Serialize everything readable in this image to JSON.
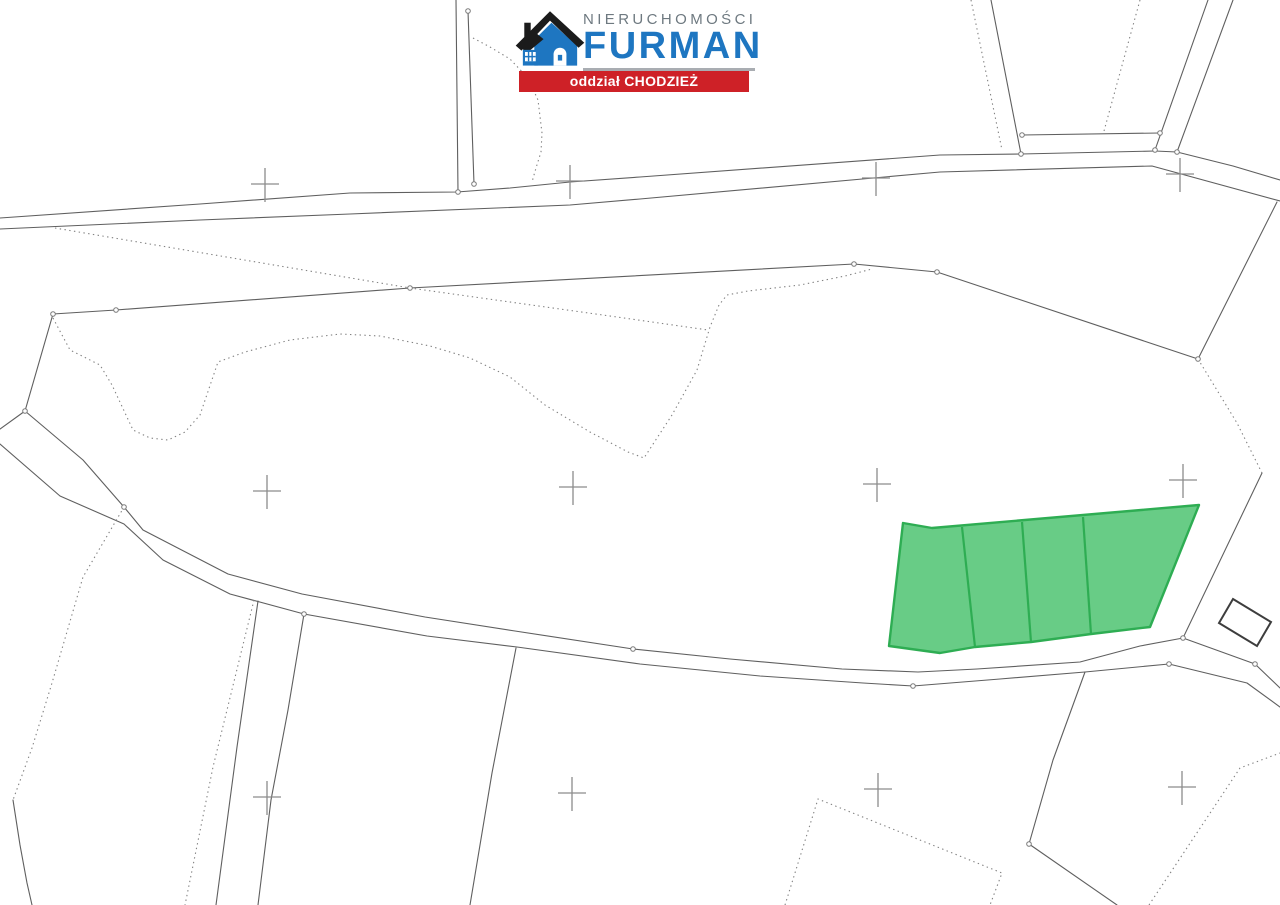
{
  "page": {
    "width": 1280,
    "height": 905,
    "background": "#ffffff"
  },
  "logo": {
    "brand_top": "NIERUCHOMOŚCI",
    "brand_main": "FURMAN",
    "banner_text": "oddział CHODZIEŻ",
    "colors": {
      "blue": "#1e76c1",
      "roof_dark": "#1b1b1b",
      "gray_text": "#6e7980",
      "underline": "#a9adb2",
      "banner_bg": "#ce2127",
      "banner_text": "#ffffff"
    }
  },
  "map": {
    "line_color": "#5f5f5f",
    "dotted_color": "#828282",
    "cross_color": "#8c8c8c",
    "vertex_color": "#7a7a7a",
    "green_fill": "#5bc87c",
    "green_stroke": "#2ead53",
    "line_width": 1.1,
    "dash_pattern": "1.4 3.4",
    "cross_arm_h": 14,
    "cross_arm_v": 16,
    "solid_lines": [
      {
        "name": "road-north-top-line",
        "points": [
          [
            0,
            218
          ],
          [
            200,
            204
          ],
          [
            350,
            193
          ],
          [
            457,
            192
          ],
          [
            510,
            188
          ],
          [
            570,
            182
          ],
          [
            640,
            177
          ],
          [
            940,
            155
          ],
          [
            1021,
            154
          ],
          [
            1155,
            151
          ],
          [
            1177,
            152
          ],
          [
            1233,
            166
          ],
          [
            1280,
            180
          ]
        ]
      },
      {
        "name": "road-north-bottom-line",
        "points": [
          [
            0,
            229
          ],
          [
            200,
            220
          ],
          [
            350,
            214
          ],
          [
            570,
            205
          ],
          [
            640,
            199
          ],
          [
            940,
            172
          ],
          [
            1152,
            166
          ],
          [
            1280,
            201
          ]
        ]
      },
      {
        "name": "north-vertical-boundary-1",
        "points": [
          [
            456,
            0
          ],
          [
            458,
            192
          ]
        ]
      },
      {
        "name": "north-vertical-boundary-2",
        "points": [
          [
            468,
            11
          ],
          [
            474,
            184
          ]
        ]
      },
      {
        "name": "upward-road-left-edge",
        "points": [
          [
            991,
            0
          ],
          [
            1021,
            154
          ]
        ]
      },
      {
        "name": "upward-road-right-edge-inner",
        "points": [
          [
            1208,
            0
          ],
          [
            1155,
            150
          ]
        ]
      },
      {
        "name": "upward-road-right-edge-outer",
        "points": [
          [
            1233,
            0
          ],
          [
            1177,
            152
          ]
        ]
      },
      {
        "name": "upward-road-connector",
        "points": [
          [
            1022,
            135
          ],
          [
            1160,
            133
          ]
        ]
      },
      {
        "name": "big-parcel-north-boundary",
        "points": [
          [
            53,
            314
          ],
          [
            116,
            310
          ],
          [
            410,
            288
          ],
          [
            854,
            264
          ],
          [
            937,
            272
          ],
          [
            1198,
            359
          ]
        ]
      },
      {
        "name": "east-boundary-upper-link",
        "points": [
          [
            1277,
            202
          ],
          [
            1198,
            359
          ]
        ]
      },
      {
        "name": "east-boundary-lower-link",
        "points": [
          [
            1262,
            473
          ],
          [
            1183,
            638
          ]
        ]
      },
      {
        "name": "big-parcel-west-edge",
        "points": [
          [
            53,
            314
          ],
          [
            25,
            411
          ]
        ]
      },
      {
        "name": "se-road-upper-line",
        "points": [
          [
            0,
            429
          ],
          [
            25,
            411
          ],
          [
            83,
            460
          ],
          [
            124,
            507
          ],
          [
            143,
            530
          ],
          [
            228,
            574
          ],
          [
            302,
            594
          ],
          [
            425,
            617
          ],
          [
            515,
            631
          ],
          [
            633,
            649
          ],
          [
            730,
            659
          ],
          [
            842,
            669
          ],
          [
            918,
            672
          ],
          [
            977,
            669
          ],
          [
            1080,
            662
          ],
          [
            1140,
            646
          ],
          [
            1183,
            638
          ],
          [
            1255,
            664
          ],
          [
            1280,
            688
          ]
        ]
      },
      {
        "name": "se-road-lower-line",
        "points": [
          [
            0,
            444
          ],
          [
            60,
            496
          ],
          [
            124,
            524
          ],
          [
            163,
            560
          ],
          [
            230,
            594
          ],
          [
            304,
            614
          ],
          [
            427,
            636
          ],
          [
            517,
            647
          ],
          [
            640,
            664
          ],
          [
            760,
            676
          ],
          [
            863,
            683
          ],
          [
            913,
            686
          ],
          [
            1000,
            679
          ],
          [
            1085,
            672
          ],
          [
            1169,
            664
          ],
          [
            1247,
            683
          ],
          [
            1280,
            707
          ]
        ]
      },
      {
        "name": "south-boundary-a",
        "points": [
          [
            258,
            601
          ],
          [
            237,
            747
          ],
          [
            216,
            905
          ]
        ]
      },
      {
        "name": "south-boundary-b",
        "points": [
          [
            304,
            614
          ],
          [
            288,
            710
          ],
          [
            271,
            800
          ],
          [
            258,
            905
          ]
        ]
      },
      {
        "name": "south-boundary-c",
        "points": [
          [
            516,
            648
          ],
          [
            492,
            773
          ],
          [
            470,
            905
          ]
        ]
      },
      {
        "name": "south-boundary-d",
        "points": [
          [
            1085,
            672
          ],
          [
            1053,
            760
          ],
          [
            1029,
            844
          ],
          [
            1117,
            905
          ]
        ]
      },
      {
        "name": "southwest-corner-boundary",
        "points": [
          [
            13,
            800
          ],
          [
            20,
            845
          ],
          [
            27,
            883
          ],
          [
            32,
            905
          ]
        ]
      }
    ],
    "dotted_lines": [
      {
        "name": "north-curve-dotted",
        "points": [
          [
            473,
            38
          ],
          [
            490,
            47
          ],
          [
            510,
            59
          ],
          [
            528,
            78
          ],
          [
            538,
            100
          ],
          [
            542,
            133
          ],
          [
            541,
            152
          ],
          [
            536,
            168
          ],
          [
            532,
            182
          ]
        ]
      },
      {
        "name": "upward-road-left-dotted",
        "points": [
          [
            971,
            0
          ],
          [
            1002,
            150
          ]
        ]
      },
      {
        "name": "upward-road-middle-dotted",
        "points": [
          [
            1140,
            0
          ],
          [
            1104,
            131
          ]
        ]
      },
      {
        "name": "north-diagonal-dotted",
        "points": [
          [
            55,
            228
          ],
          [
            410,
            288
          ],
          [
            617,
            317
          ],
          [
            708,
            330
          ]
        ]
      },
      {
        "name": "landuse-wavy-dotted",
        "points": [
          [
            53,
            318
          ],
          [
            70,
            350
          ],
          [
            100,
            365
          ],
          [
            112,
            385
          ],
          [
            133,
            430
          ],
          [
            150,
            438
          ],
          [
            168,
            440
          ],
          [
            185,
            432
          ],
          [
            200,
            415
          ],
          [
            218,
            362
          ],
          [
            245,
            352
          ],
          [
            290,
            340
          ],
          [
            340,
            334
          ],
          [
            380,
            336
          ],
          [
            430,
            346
          ],
          [
            470,
            358
          ],
          [
            510,
            377
          ],
          [
            545,
            405
          ],
          [
            590,
            432
          ],
          [
            628,
            452
          ],
          [
            644,
            458
          ],
          [
            672,
            415
          ],
          [
            697,
            370
          ],
          [
            710,
            327
          ],
          [
            719,
            305
          ],
          [
            727,
            295
          ],
          [
            748,
            291
          ],
          [
            800,
            285
          ],
          [
            845,
            276
          ],
          [
            872,
            269
          ]
        ]
      },
      {
        "name": "east-dotted-link",
        "points": [
          [
            1198,
            359
          ],
          [
            1237,
            423
          ],
          [
            1262,
            473
          ]
        ]
      },
      {
        "name": "southwest-steep-dotted",
        "points": [
          [
            124,
            507
          ],
          [
            83,
            577
          ],
          [
            52,
            683
          ],
          [
            32,
            748
          ],
          [
            13,
            800
          ]
        ]
      },
      {
        "name": "south-dotted-a",
        "points": [
          [
            254,
            600
          ],
          [
            213,
            767
          ],
          [
            185,
            905
          ]
        ]
      },
      {
        "name": "south-v-dotted",
        "points": [
          [
            785,
            905
          ],
          [
            818,
            799
          ],
          [
            1002,
            873
          ],
          [
            990,
            905
          ]
        ]
      },
      {
        "name": "southeast-dotted",
        "points": [
          [
            1149,
            905
          ],
          [
            1240,
            768
          ],
          [
            1280,
            753
          ]
        ]
      }
    ],
    "building": {
      "name": "building-outline",
      "color": "#3d3d3d",
      "points": [
        [
          1233,
          599
        ],
        [
          1271,
          622
        ],
        [
          1257,
          646
        ],
        [
          1219,
          623
        ]
      ]
    },
    "green_area": {
      "outline": [
        [
          903,
          523
        ],
        [
          932,
          528
        ],
        [
          1199,
          505
        ],
        [
          1150,
          627
        ],
        [
          1091,
          634
        ],
        [
          1031,
          642
        ],
        [
          975,
          647
        ],
        [
          940,
          653
        ],
        [
          889,
          646
        ]
      ],
      "dividers": [
        [
          [
            962,
            527
          ],
          [
            975,
            647
          ]
        ],
        [
          [
            1022,
            522
          ],
          [
            1031,
            642
          ]
        ],
        [
          [
            1083,
            517
          ],
          [
            1091,
            634
          ]
        ]
      ]
    },
    "crosses": [
      [
        265,
        184
      ],
      [
        570,
        181
      ],
      [
        876,
        178
      ],
      [
        1180,
        174
      ],
      [
        267,
        491
      ],
      [
        573,
        487
      ],
      [
        877,
        484
      ],
      [
        1183,
        480
      ],
      [
        267,
        797
      ],
      [
        572,
        793
      ],
      [
        878,
        789
      ],
      [
        1182,
        787
      ]
    ],
    "vertices": [
      [
        468,
        11
      ],
      [
        458,
        192
      ],
      [
        474,
        184
      ],
      [
        116,
        310
      ],
      [
        53,
        314
      ],
      [
        25,
        411
      ],
      [
        410,
        288
      ],
      [
        854,
        264
      ],
      [
        937,
        272
      ],
      [
        1198,
        359
      ],
      [
        1021,
        154
      ],
      [
        1022,
        135
      ],
      [
        1160,
        133
      ],
      [
        1155,
        150
      ],
      [
        1177,
        152
      ],
      [
        633,
        649
      ],
      [
        1183,
        638
      ],
      [
        1169,
        664
      ],
      [
        1255,
        664
      ],
      [
        1029,
        844
      ],
      [
        913,
        686
      ],
      [
        304,
        614
      ],
      [
        124,
        507
      ]
    ]
  }
}
